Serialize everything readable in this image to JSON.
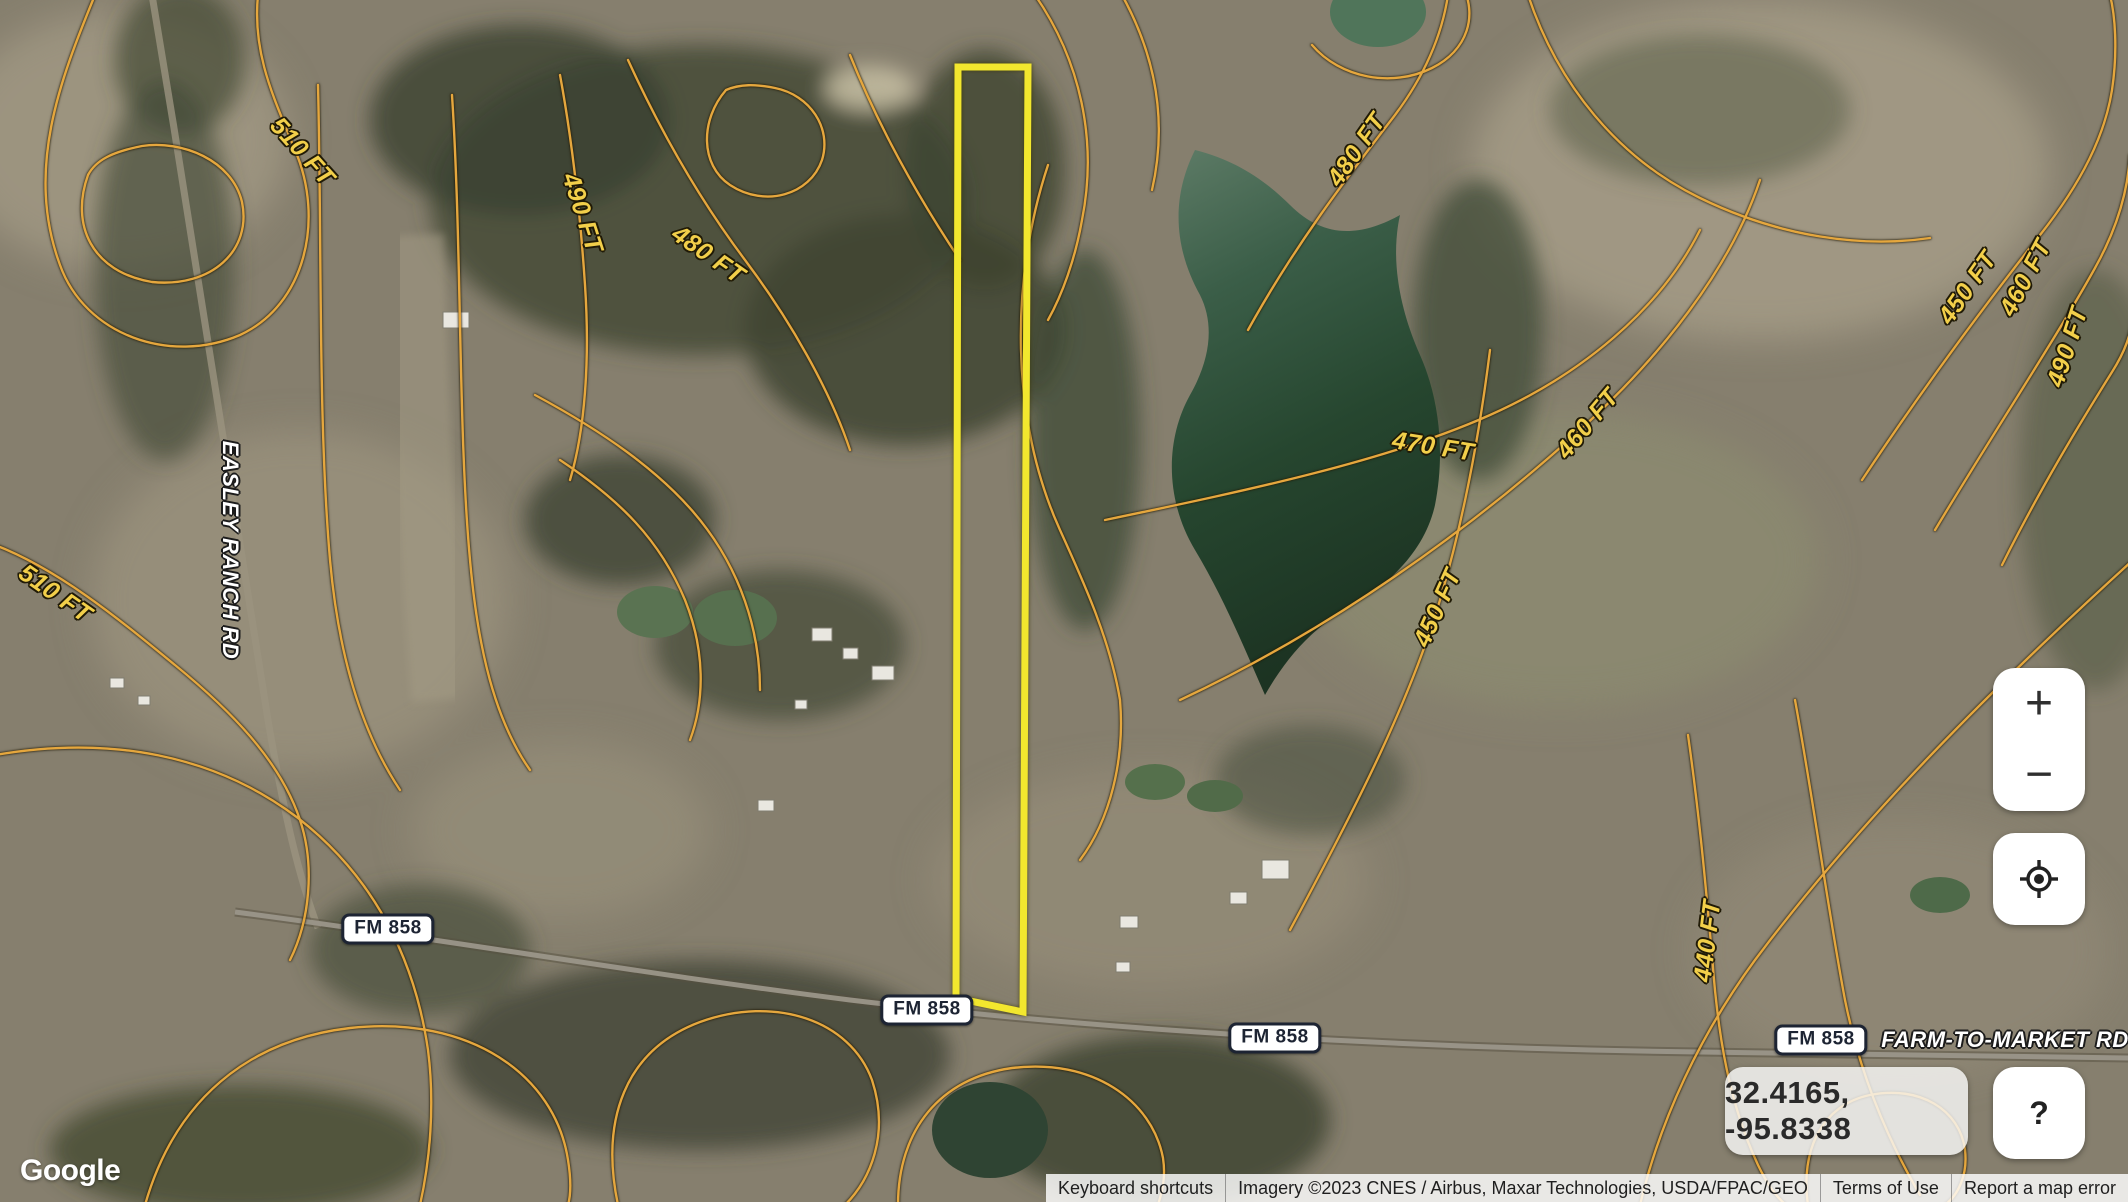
{
  "map": {
    "parcel_outline_color": "#f2e72e",
    "contour_color": "#e5a73e",
    "contour_label_color": "#f2cf4a",
    "water_color": "#2e4a38"
  },
  "contour_labels": [
    {
      "text": "510 FT",
      "x": 302,
      "y": 152,
      "rot": 48
    },
    {
      "text": "490 FT",
      "x": 582,
      "y": 213,
      "rot": 72
    },
    {
      "text": "480 FT",
      "x": 708,
      "y": 255,
      "rot": 35
    },
    {
      "text": "480 FT",
      "x": 1357,
      "y": 150,
      "rot": -55
    },
    {
      "text": "450 FT",
      "x": 1968,
      "y": 288,
      "rot": -55
    },
    {
      "text": "460 FT",
      "x": 2026,
      "y": 278,
      "rot": -62
    },
    {
      "text": "490 FT",
      "x": 2068,
      "y": 347,
      "rot": -72
    },
    {
      "text": "470 FT",
      "x": 1433,
      "y": 447,
      "rot": 9
    },
    {
      "text": "460 FT",
      "x": 1588,
      "y": 424,
      "rot": -50
    },
    {
      "text": "510 FT",
      "x": 55,
      "y": 594,
      "rot": 35
    },
    {
      "text": "450 FT",
      "x": 1438,
      "y": 608,
      "rot": -66
    },
    {
      "text": "440 FT",
      "x": 1708,
      "y": 941,
      "rot": -83
    }
  ],
  "road_badges": [
    {
      "text": "FM 858",
      "x": 388,
      "y": 929
    },
    {
      "text": "FM 858",
      "x": 927,
      "y": 1010
    },
    {
      "text": "FM 858",
      "x": 1275,
      "y": 1038
    },
    {
      "text": "FM 858",
      "x": 1821,
      "y": 1040
    }
  ],
  "road_names": [
    {
      "text": "EASLEY RANCH RD",
      "x": 230,
      "y": 550,
      "rot": 90
    },
    {
      "text": "FARM-TO-MARKET RD",
      "x": 2005,
      "y": 1040,
      "rot": 0
    }
  ],
  "controls": {
    "zoom_in": "+",
    "zoom_out": "−",
    "help": "?",
    "coordinates": "32.4165, -95.8338"
  },
  "branding": {
    "logo": "Google"
  },
  "attribution": {
    "keyboard_shortcuts": "Keyboard shortcuts",
    "imagery": "Imagery ©2023 CNES / Airbus, Maxar Technologies, USDA/FPAC/GEO",
    "terms": "Terms of Use",
    "report": "Report a map error"
  }
}
